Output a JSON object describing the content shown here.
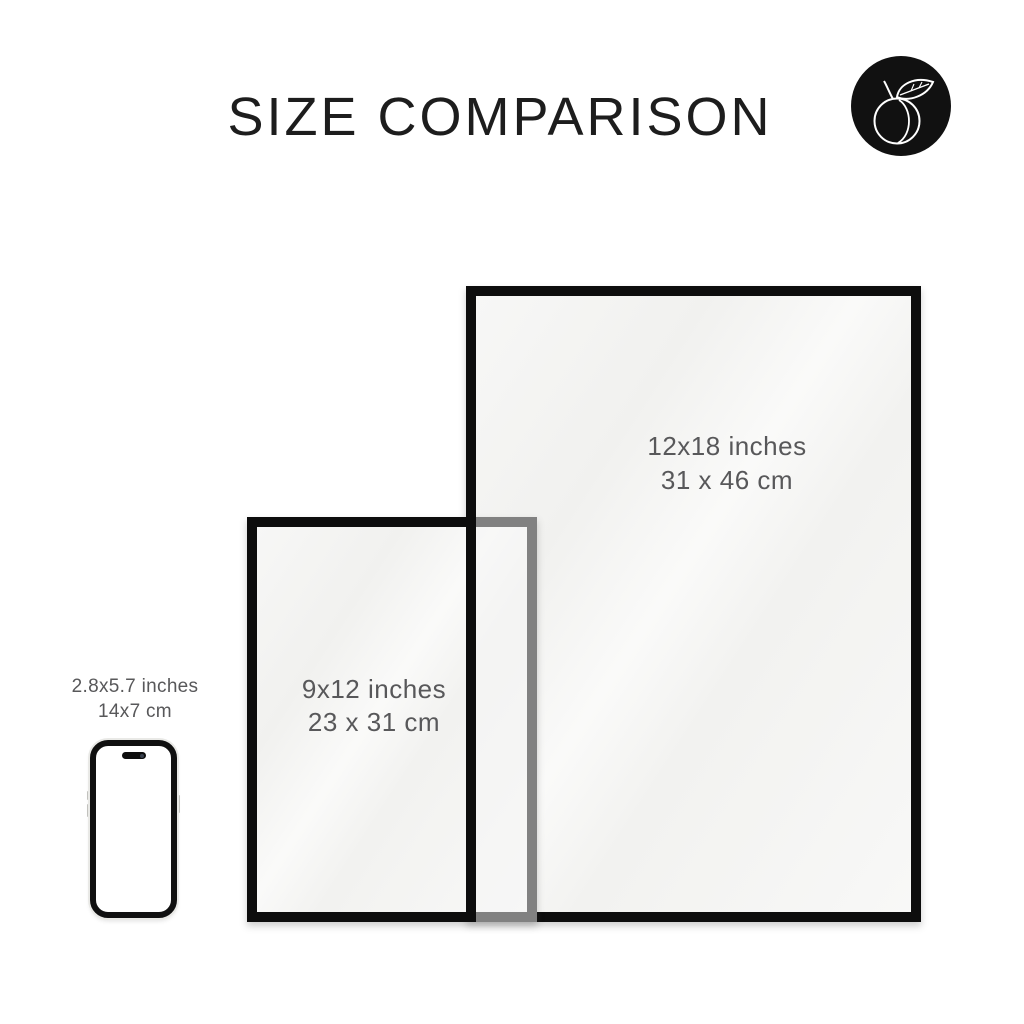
{
  "header": {
    "title": "SIZE COMPARISON"
  },
  "brand": {
    "icon": "peach-icon"
  },
  "comparison": {
    "large_frame": {
      "size_inches": "12x18 inches",
      "size_cm": "31 x 46 cm"
    },
    "small_frame": {
      "size_inches": "9x12 inches",
      "size_cm": "23 x 31 cm"
    },
    "phone": {
      "size_inches": "2.8x5.7 inches",
      "size_cm": "14x7 cm"
    }
  },
  "colors": {
    "background": "#ffffff",
    "frame_border": "#0d0d0d",
    "frame_fill": "#f5f5f4",
    "title_text": "#1d1d1d",
    "label_text": "#58585a",
    "badge_background": "#111111",
    "badge_glyph": "#ffffff",
    "phone_edge": "#e9e9e6"
  }
}
